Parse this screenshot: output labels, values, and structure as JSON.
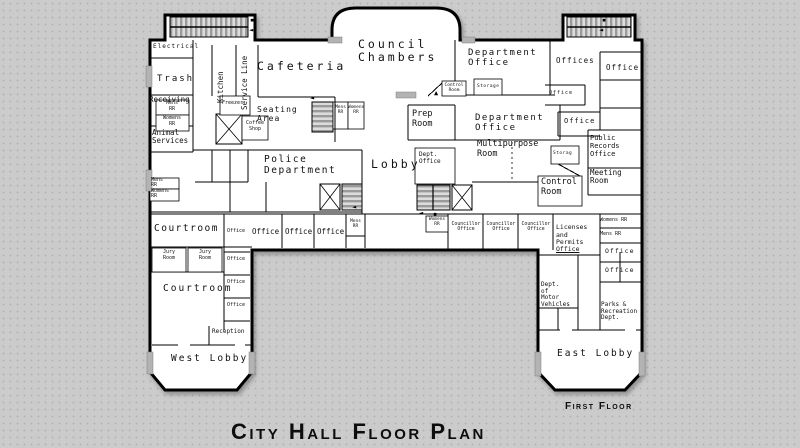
{
  "title": "City Hall Floor Plan",
  "floor_label": "First Floor",
  "colors": {
    "background": "#cbcbcb",
    "wall": "#000000",
    "floor": "#ffffff",
    "door": "#b3b3b3",
    "stair_hatch": "#9a9a9a"
  },
  "icons": {
    "stair_arrow_left": "◄",
    "entry_arrow_up": "▲",
    "door_bar": "▪"
  },
  "labels": {
    "electrical": "Electrical",
    "trash": "Trash",
    "receiving": "Receiving",
    "mens_rr_a": "Mens\nRR",
    "womens_rr_a": "Womens\nRR",
    "animal_services": "Animal\nServices",
    "kitchen": "Kitchen",
    "service_line": "Service Line",
    "cafeteria": "Cafeteria",
    "freezer": "Freezer",
    "coffee_shop": "Coffee\nShop",
    "seating_area": "Seating\nArea",
    "mens_rr_b": "Mens\nRR",
    "womens_rr_b": "Womens\nRR",
    "police_department": "Police\nDepartment",
    "lobby": "Lobby",
    "mens_rr_c": "Mens\nRR",
    "womens_rr_c": "Womens\nRR",
    "council_chambers": "Council\nChambers",
    "council_control_room": "Control\nRoom",
    "department_office_top": "Department\nOffice",
    "storage_a": "Storage",
    "offices": "Offices",
    "office_r1": "Office",
    "office_r2": "Office",
    "office_r3": "Office",
    "prep_room": "Prep\nRoom",
    "department_office_mid": "Department\nOffice",
    "multipurpose_room": "Multipurpose\nRoom",
    "storage_b": "Storag",
    "public_records_office": "Public\nRecords\nOffice",
    "meeting_room": "Meeting\nRoom",
    "control_room_mid": "Control\nRoom",
    "dept_office_center": "Dept.\nOffice",
    "womens_rr_d": "Womens\nRR",
    "councillor_1": "Councillor\nOffice",
    "councillor_2": "Councillor\nOffice",
    "councillor_3": "Councillor\nOffice",
    "licenses_main": "Licenses\nand\nPermits",
    "licenses_office": "Office",
    "womens_rr_e": "Womens RR",
    "mens_rr_e": "Mens RR",
    "office_rc1": "Office",
    "office_rc2": "Office",
    "courtroom_1": "Courtroom",
    "office_row_a": "Office",
    "office_row_b": "Office",
    "office_row_c": "Office",
    "office_row_d": "Office",
    "mens_rr_d": "Mens\nRR",
    "jury_room_1": "Jury\nRoom",
    "jury_room_2": "Jury\nRoom",
    "office_col_1": "Office",
    "office_col_2": "Office",
    "office_col_3": "Office",
    "courtroom_2": "Courtroom",
    "reception": "Reception",
    "west_lobby": "West Lobby",
    "dept_motor_vehicles": "Dept.\nof\nMotor\nVehicles",
    "parks_recreation": "Parks &\nRecreation\nDept.",
    "east_lobby": "East Lobby"
  }
}
